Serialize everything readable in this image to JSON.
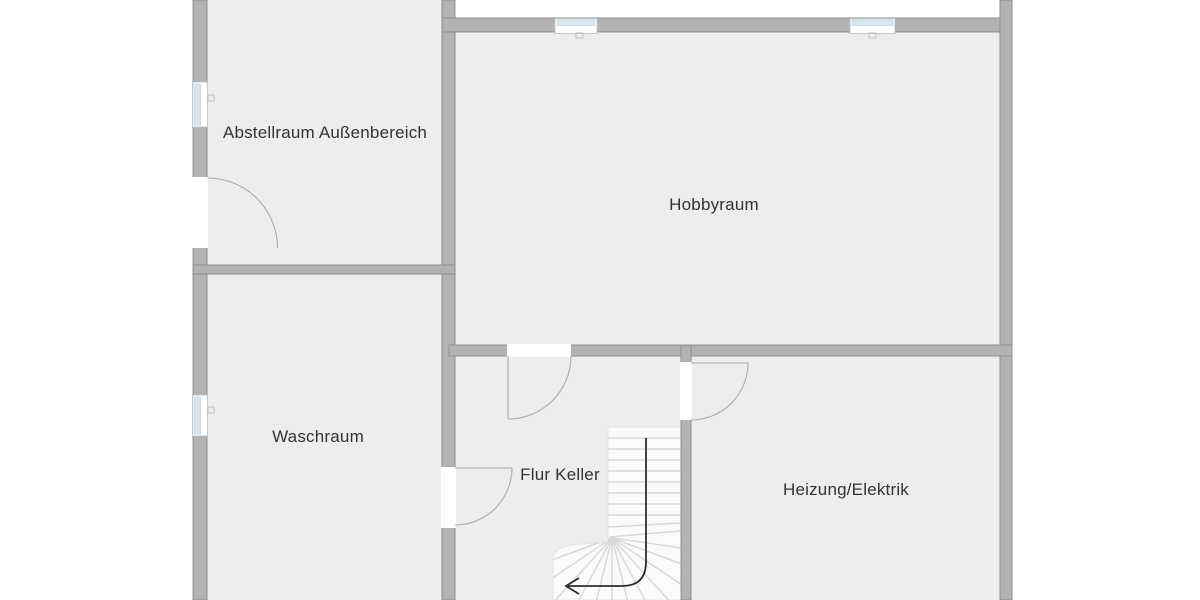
{
  "floor_plan": {
    "rooms": [
      {
        "name": "abstellraum-aussenbereich",
        "label": "Abstellraum Außenbereich"
      },
      {
        "name": "hobbyraum",
        "label": "Hobbyraum"
      },
      {
        "name": "waschraum",
        "label": "Waschraum"
      },
      {
        "name": "flur-keller",
        "label": "Flur Keller"
      },
      {
        "name": "heizung-elektrik",
        "label": "Heizung/Elektrik"
      }
    ],
    "features": {
      "windows_count": 4,
      "exterior_doors_count": 1,
      "interior_doors_count": 3,
      "staircase": {
        "type": "quarter-turn-winder-stair",
        "direction_arrow": "down-then-left"
      }
    },
    "colors": {
      "page_background": "#ffffff",
      "room_fill": "#ededed",
      "wall_fill": "#b3b3b3",
      "wall_outline": "#8f8f8f",
      "window_pane": "#d9e6ee",
      "window_frame": "#ffffff",
      "door_swing": "#ababab",
      "stair_fill": "#fbfbfb",
      "stair_tread": "#d8d8d8",
      "arrow": "#2d2d2d",
      "label_text": "#333333"
    }
  }
}
